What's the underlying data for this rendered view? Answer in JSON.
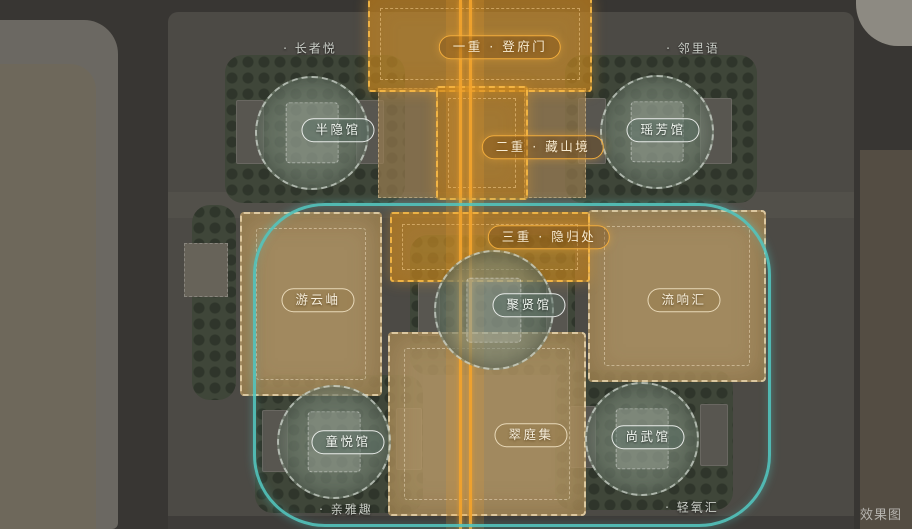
{
  "watermark": "效果图",
  "colors": {
    "axis_orange": "#f2a32c",
    "zone_tan": "#ba9b66",
    "loop_teal": "#52c4be",
    "ground_dark": "#45433f",
    "greenery": "#3e4638"
  },
  "axis_labels": [
    {
      "id": "layer-1",
      "text": "一重 · 登府门"
    },
    {
      "id": "layer-2",
      "text": "二重 · 藏山境"
    },
    {
      "id": "layer-3",
      "text": "三重 · 隐归处"
    }
  ],
  "pavilions": [
    {
      "id": "banyin",
      "label": "半隐馆"
    },
    {
      "id": "yaofang",
      "label": "瑶芳馆"
    },
    {
      "id": "juxian",
      "label": "聚贤馆"
    },
    {
      "id": "tongyue",
      "label": "童悦馆"
    },
    {
      "id": "shangwu",
      "label": "尚武馆"
    }
  ],
  "courtyards": [
    {
      "id": "youyunxiu",
      "label": "游云岫"
    },
    {
      "id": "liuxianghui",
      "label": "流响汇"
    },
    {
      "id": "cuitingji",
      "label": "翠庭集"
    }
  ],
  "corner_notes": [
    {
      "id": "zhangzheyue",
      "text": "· 长者悦"
    },
    {
      "id": "linliyu",
      "text": "· 邻里语"
    },
    {
      "id": "qinyaqu",
      "text": "· 亲雅趣"
    },
    {
      "id": "qingyanghui",
      "text": "· 轻氧汇"
    }
  ]
}
